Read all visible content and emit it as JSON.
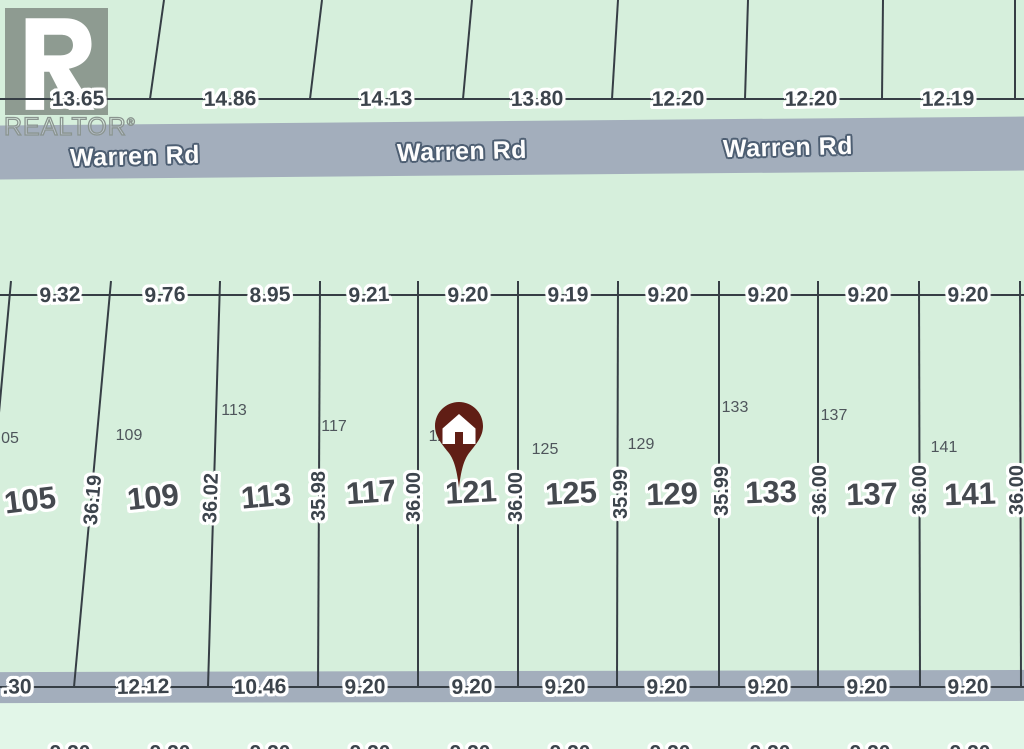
{
  "colors": {
    "background": "#d6efdc",
    "background_south": "#e2f6e8",
    "road": "#a3aebc",
    "line": "#363e45",
    "dim_text": "#3c444c",
    "lot_text": "#45494f",
    "small_text": "#4e555b",
    "road_text": "#fdfdfd",
    "road_text_outline": "#4d5e72",
    "halo": "#ffffff",
    "pin": "#601e15"
  },
  "branding": {
    "wordmark": "REALTOR",
    "registered_mark": "®",
    "logo_letter": "R"
  },
  "roads": [
    {
      "name": "Warren Rd",
      "band": {
        "y": 121,
        "h": 54,
        "rot": -0.5
      },
      "labels": [
        {
          "text": "Warren Rd",
          "x": 135,
          "y": 157,
          "rot": -1.5
        },
        {
          "text": "Warren Rd",
          "x": 462,
          "y": 152,
          "rot": -1.5
        },
        {
          "text": "Warren Rd",
          "x": 788,
          "y": 148,
          "rot": -1.5
        }
      ]
    },
    {
      "name": "",
      "band": {
        "y": 671,
        "h": 31,
        "rot": -0.12
      },
      "labels": []
    }
  ],
  "dimension_rows": [
    {
      "id": "north-frontage",
      "line_y": 99,
      "labels": [
        {
          "t": "13.65",
          "x": 78,
          "rot": -1
        },
        {
          "t": "14.86",
          "x": 230,
          "rot": -1
        },
        {
          "t": "14.13",
          "x": 386,
          "rot": -1
        },
        {
          "t": "13.80",
          "x": 537,
          "rot": -1
        },
        {
          "t": "12.20",
          "x": 678,
          "rot": -1
        },
        {
          "t": "12.20",
          "x": 811,
          "rot": -1
        },
        {
          "t": "12.19",
          "x": 948,
          "rot": -1
        }
      ]
    },
    {
      "id": "lot-frontage",
      "line_y": 295,
      "labels": [
        {
          "t": "9.32",
          "x": 60,
          "rot": -2
        },
        {
          "t": "9.76",
          "x": 165,
          "rot": -2
        },
        {
          "t": "8.95",
          "x": 270,
          "rot": -2
        },
        {
          "t": "9.21",
          "x": 369,
          "rot": -2
        },
        {
          "t": "9.20",
          "x": 468,
          "rot": -2
        },
        {
          "t": "9.19",
          "x": 568,
          "rot": -1
        },
        {
          "t": "9.20",
          "x": 668,
          "rot": -1
        },
        {
          "t": "9.20",
          "x": 768,
          "rot": -1
        },
        {
          "t": "9.20",
          "x": 868,
          "rot": -1
        },
        {
          "t": "9.20",
          "x": 968,
          "rot": -1
        }
      ]
    },
    {
      "id": "lot-rear",
      "line_y": 687,
      "labels": [
        {
          "t": ".30",
          "x": 17,
          "rot": -1
        },
        {
          "t": "12.12",
          "x": 143,
          "rot": -1
        },
        {
          "t": "10.46",
          "x": 260,
          "rot": -1
        },
        {
          "t": "9.20",
          "x": 365,
          "rot": -1
        },
        {
          "t": "9.20",
          "x": 472,
          "rot": -1
        },
        {
          "t": "9.20",
          "x": 565,
          "rot": -1
        },
        {
          "t": "9.20",
          "x": 667,
          "rot": -1
        },
        {
          "t": "9.20",
          "x": 768,
          "rot": -1
        },
        {
          "t": "9.20",
          "x": 867,
          "rot": -1
        },
        {
          "t": "9.20",
          "x": 968,
          "rot": -1
        }
      ]
    },
    {
      "id": "south-clipped",
      "line_y": null,
      "labels": [
        {
          "t": "9.20",
          "x": 70,
          "y": 753
        },
        {
          "t": "9.20",
          "x": 170,
          "y": 753
        },
        {
          "t": "9.20",
          "x": 270,
          "y": 753
        },
        {
          "t": "9.20",
          "x": 370,
          "y": 753
        },
        {
          "t": "9.20",
          "x": 470,
          "y": 753
        },
        {
          "t": "9.20",
          "x": 570,
          "y": 753
        },
        {
          "t": "9.20",
          "x": 670,
          "y": 753
        },
        {
          "t": "9.20",
          "x": 770,
          "y": 753
        },
        {
          "t": "9.20",
          "x": 870,
          "y": 753
        },
        {
          "t": "9.20",
          "x": 970,
          "y": 753
        }
      ]
    }
  ],
  "boundary_lines": {
    "north": [
      {
        "xt": 164,
        "yt": 0,
        "xb": 150,
        "yb": 99
      },
      {
        "xt": 322,
        "yt": 0,
        "xb": 310,
        "yb": 99
      },
      {
        "xt": 472,
        "yt": 0,
        "xb": 463,
        "yb": 99
      },
      {
        "xt": 618,
        "yt": 0,
        "xb": 612,
        "yb": 99
      },
      {
        "xt": 748,
        "yt": 0,
        "xb": 745,
        "yb": 99
      },
      {
        "xt": 883,
        "yt": 0,
        "xb": 882,
        "yb": 99
      },
      {
        "xt": 1015,
        "yt": 0,
        "xb": 1015,
        "yb": 99
      }
    ],
    "lots": [
      {
        "xt": 11,
        "yt": 281,
        "xb": -26,
        "yb": 687
      },
      {
        "xt": 111,
        "yt": 281,
        "xb": 74,
        "yb": 687
      },
      {
        "xt": 220,
        "yt": 281,
        "xb": 208,
        "yb": 687
      },
      {
        "xt": 320,
        "yt": 281,
        "xb": 318,
        "yb": 687
      },
      {
        "xt": 418,
        "yt": 281,
        "xb": 418,
        "yb": 687
      },
      {
        "xt": 518,
        "yt": 281,
        "xb": 518,
        "yb": 687
      },
      {
        "xt": 618,
        "yt": 281,
        "xb": 617,
        "yb": 687
      },
      {
        "xt": 719,
        "yt": 281,
        "xb": 719,
        "yb": 687
      },
      {
        "xt": 818,
        "yt": 281,
        "xb": 818,
        "yb": 687
      },
      {
        "xt": 919,
        "yt": 281,
        "xb": 920,
        "yb": 687
      },
      {
        "xt": 1020,
        "yt": 281,
        "xb": 1021,
        "yb": 687
      }
    ]
  },
  "lots": [
    {
      "number": "105",
      "num_x": 30,
      "num_y": 500,
      "num_rot": -7,
      "small": "05",
      "small_x": 10,
      "small_y": 439,
      "west_dim": null
    },
    {
      "number": "109",
      "num_x": 153,
      "num_y": 497,
      "num_rot": -6,
      "small": "109",
      "small_x": 129,
      "small_y": 436,
      "west_dim": {
        "t": "36.19",
        "x": 93,
        "y": 500,
        "rot": -85
      }
    },
    {
      "number": "113",
      "num_x": 266,
      "num_y": 496,
      "num_rot": -5,
      "small": "113",
      "small_x": 234,
      "small_y": 411,
      "west_dim": {
        "t": "36.02",
        "x": 211,
        "y": 498,
        "rot": -88
      }
    },
    {
      "number": "117",
      "num_x": 371,
      "num_y": 492,
      "num_rot": -4,
      "small": "117",
      "small_x": 334,
      "small_y": 427,
      "west_dim": {
        "t": "35.98",
        "x": 319,
        "y": 496,
        "rot": -90
      }
    },
    {
      "number": "121",
      "num_x": 471,
      "num_y": 492,
      "num_rot": -3,
      "small": "121",
      "small_x": 442,
      "small_y": 437,
      "west_dim": {
        "t": "36.00",
        "x": 414,
        "y": 497,
        "rot": -90
      }
    },
    {
      "number": "125",
      "num_x": 571,
      "num_y": 493,
      "num_rot": -3,
      "small": "125",
      "small_x": 545,
      "small_y": 450,
      "west_dim": {
        "t": "36.00",
        "x": 516,
        "y": 497,
        "rot": -90
      }
    },
    {
      "number": "129",
      "num_x": 672,
      "num_y": 494,
      "num_rot": -2,
      "small": "129",
      "small_x": 641,
      "small_y": 445,
      "west_dim": {
        "t": "35.99",
        "x": 621,
        "y": 494,
        "rot": -90
      }
    },
    {
      "number": "133",
      "num_x": 771,
      "num_y": 492,
      "num_rot": -2,
      "small": "133",
      "small_x": 735,
      "small_y": 408,
      "west_dim": {
        "t": "35.99",
        "x": 722,
        "y": 491,
        "rot": -90
      }
    },
    {
      "number": "137",
      "num_x": 872,
      "num_y": 494,
      "num_rot": -2,
      "small": "137",
      "small_x": 834,
      "small_y": 416,
      "west_dim": {
        "t": "36.00",
        "x": 820,
        "y": 490,
        "rot": -90
      }
    },
    {
      "number": "141",
      "num_x": 970,
      "num_y": 494,
      "num_rot": -2,
      "small": "141",
      "small_x": 944,
      "small_y": 448,
      "west_dim": {
        "t": "36.00",
        "x": 920,
        "y": 490,
        "rot": -90
      }
    }
  ],
  "east_edge_dim": {
    "t": "36.00",
    "x": 1017,
    "y": 490,
    "rot": -90
  },
  "marker": {
    "lot": "121",
    "tip_x": 459,
    "tip_y": 488,
    "w": 48,
    "h": 86,
    "icon": "house"
  }
}
